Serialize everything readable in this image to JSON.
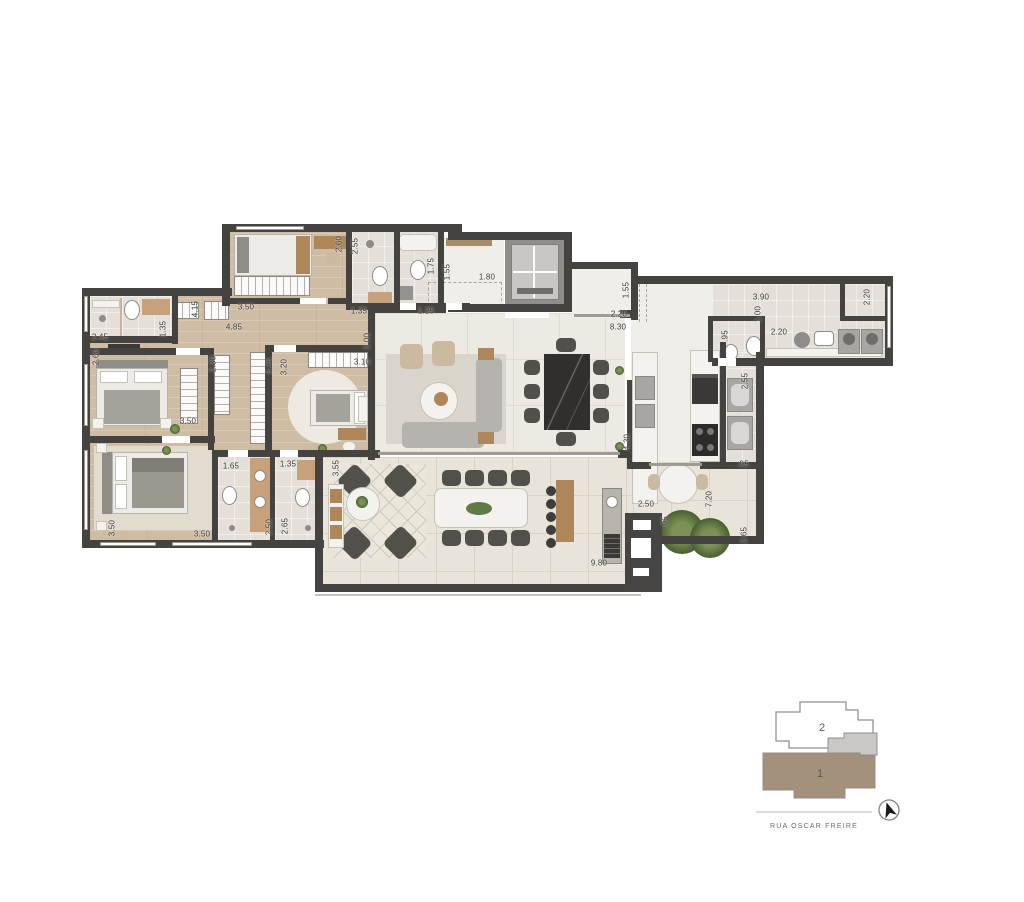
{
  "plan": {
    "dimension_labels": [
      {
        "text": "2.60",
        "x": 339,
        "y": 244,
        "v": true
      },
      {
        "text": "2.55",
        "x": 355,
        "y": 246,
        "v": true
      },
      {
        "text": "3.50",
        "x": 246,
        "y": 307,
        "v": false
      },
      {
        "text": "1.35",
        "x": 359,
        "y": 311,
        "v": false
      },
      {
        "text": "4.85",
        "x": 234,
        "y": 327,
        "v": false
      },
      {
        "text": "2.45",
        "x": 100,
        "y": 337,
        "v": false
      },
      {
        "text": "2.60",
        "x": 96,
        "y": 357,
        "v": true
      },
      {
        "text": "1.35",
        "x": 163,
        "y": 329,
        "v": true
      },
      {
        "text": "4.15",
        "x": 195,
        "y": 309,
        "v": true
      },
      {
        "text": "2.30",
        "x": 213,
        "y": 364,
        "v": true
      },
      {
        "text": "3.25",
        "x": 269,
        "y": 366,
        "v": true
      },
      {
        "text": "3.20",
        "x": 284,
        "y": 367,
        "v": true
      },
      {
        "text": "3.10",
        "x": 362,
        "y": 362,
        "v": false
      },
      {
        "text": "1.00",
        "x": 367,
        "y": 341,
        "v": true
      },
      {
        "text": "1.75",
        "x": 431,
        "y": 266,
        "v": true
      },
      {
        "text": "1.55",
        "x": 447,
        "y": 272,
        "v": true
      },
      {
        "text": "1.80",
        "x": 487,
        "y": 277,
        "v": false
      },
      {
        "text": "1.25",
        "x": 426,
        "y": 311,
        "v": false
      },
      {
        "text": "1.55",
        "x": 626,
        "y": 290,
        "v": true
      },
      {
        "text": "2.20",
        "x": 619,
        "y": 314,
        "v": false
      },
      {
        "text": "8.30",
        "x": 618,
        "y": 327,
        "v": false
      },
      {
        "text": "3.90",
        "x": 761,
        "y": 297,
        "v": false
      },
      {
        "text": "1.00",
        "x": 758,
        "y": 314,
        "v": true
      },
      {
        "text": "2.20",
        "x": 867,
        "y": 297,
        "v": true
      },
      {
        "text": ".95",
        "x": 725,
        "y": 336,
        "v": true
      },
      {
        "text": "2.20",
        "x": 779,
        "y": 332,
        "v": false
      },
      {
        "text": "2.55",
        "x": 745,
        "y": 381,
        "v": true
      },
      {
        "text": "4.30",
        "x": 627,
        "y": 442,
        "v": true
      },
      {
        "text": ".95",
        "x": 743,
        "y": 464,
        "v": false
      },
      {
        "text": "2.50",
        "x": 646,
        "y": 504,
        "v": false
      },
      {
        "text": "7.20",
        "x": 709,
        "y": 499,
        "v": true
      },
      {
        "text": ".95",
        "x": 665,
        "y": 522,
        "v": true
      },
      {
        "text": "2.65",
        "x": 744,
        "y": 535,
        "v": true
      },
      {
        "text": "9.80",
        "x": 599,
        "y": 563,
        "v": false
      },
      {
        "text": "3.55",
        "x": 336,
        "y": 468,
        "v": true
      },
      {
        "text": "1.65",
        "x": 231,
        "y": 466,
        "v": false
      },
      {
        "text": "1.35",
        "x": 288,
        "y": 464,
        "v": false
      },
      {
        "text": "2.50",
        "x": 269,
        "y": 527,
        "v": true
      },
      {
        "text": "2.65",
        "x": 285,
        "y": 526,
        "v": true
      },
      {
        "text": "3.50",
        "x": 202,
        "y": 534,
        "v": false
      },
      {
        "text": "3.50",
        "x": 112,
        "y": 528,
        "v": true
      },
      {
        "text": "3.50",
        "x": 188,
        "y": 421,
        "v": false
      }
    ]
  },
  "key_plan": {
    "unit_top_label": "2",
    "unit_bottom_label": "1",
    "street_name": "RUA OSCAR FREIRE"
  },
  "colors": {
    "wall": "#454340",
    "wood_floor": "#cfbca4",
    "tile_floor": "#e4e0d9",
    "terrace_floor": "#e8e4d9",
    "dark_table": "#302f2d",
    "plant_green": "#42592c",
    "keyplan_unit1": "#a3917b",
    "keyplan_overlap": "#c9c8c5"
  }
}
